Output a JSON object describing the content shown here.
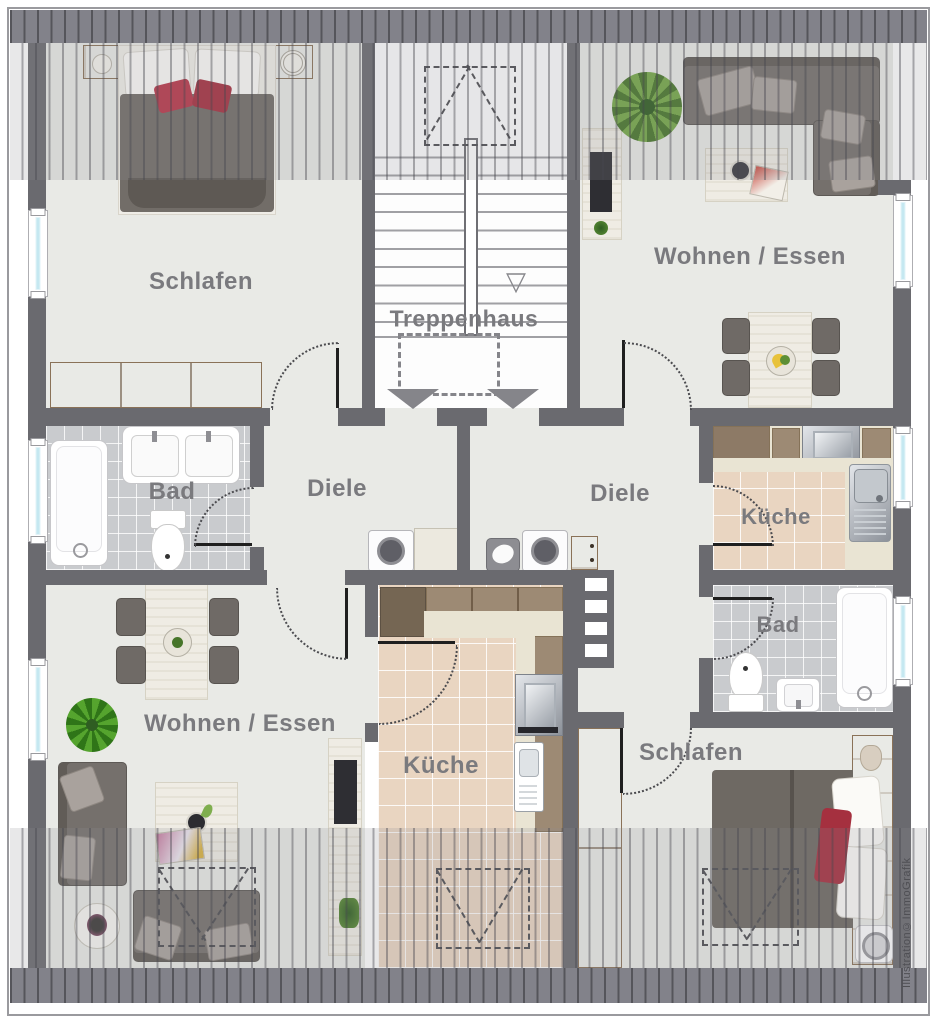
{
  "watermark": "Illustration©ImmoGrafik",
  "rooms": {
    "schlafen_tl": {
      "label": "Schlafen"
    },
    "treppenhaus": {
      "label": "Treppenhaus"
    },
    "wohnen_tr": {
      "label": "Wohnen / Essen"
    },
    "bad_l": {
      "label": "Bad"
    },
    "diele_l": {
      "label": "Diele"
    },
    "diele_r": {
      "label": "Diele"
    },
    "kueche_r": {
      "label": "Küche"
    },
    "bad_r": {
      "label": "Bad"
    },
    "wohnen_bl": {
      "label": "Wohnen / Essen"
    },
    "kueche_bl": {
      "label": "Küche"
    },
    "schlafen_br": {
      "label": "Schlafen"
    }
  },
  "stairs": {
    "down_marker": "▽"
  },
  "colors": {
    "wall": "#6a6a6f",
    "floor": "#e9eae6",
    "bath_tile": "#c9cbce",
    "kitchen_tile": "#e9d5c1",
    "roof_band": "#82828a",
    "accent_red": "#b8374a",
    "wood": "#a9906f",
    "window_glass": "#c5e8f1",
    "label_text": "#7a7a7e"
  },
  "furniture": [
    "double-bed",
    "nightstand",
    "sideboard",
    "staircase",
    "skylight",
    "corner-sofa",
    "sofa",
    "coffee-table",
    "dining-table",
    "chair",
    "plant",
    "tv-board",
    "bathtub",
    "double-washbasin",
    "washbasin",
    "toilet",
    "kitchen-counter",
    "stove",
    "kitchen-sink",
    "washing-machine",
    "laundry-chair",
    "dresser",
    "shelf-unit",
    "wardrobe",
    "side-table",
    "bed"
  ]
}
